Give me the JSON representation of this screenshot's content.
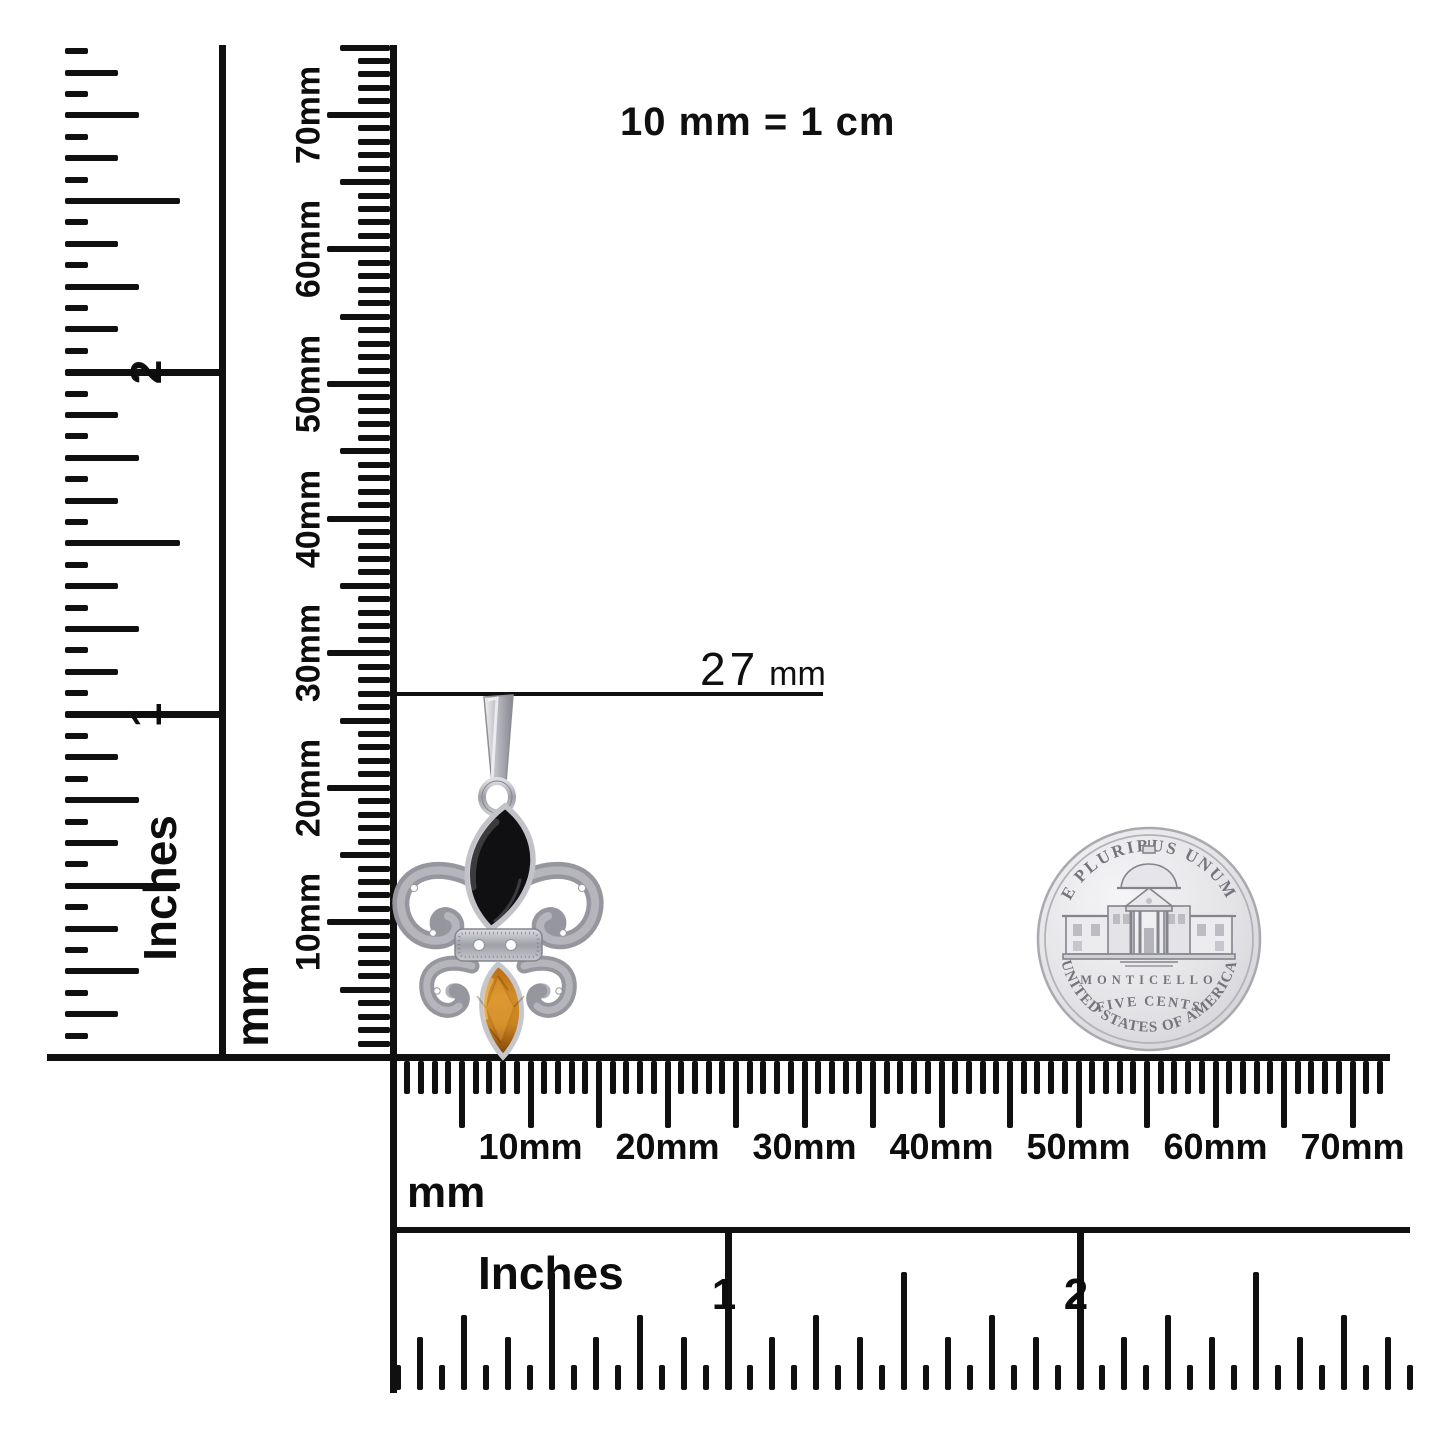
{
  "colors": {
    "ink": "#101010",
    "background": "#ffffff",
    "silver": "#c6c6cc",
    "silver_dark": "#8e8e96",
    "coin_face": "#dcdcdf",
    "coin_engraving": "#74747c",
    "onyx": "#101013",
    "citrine": "#c97a16",
    "citrine_dark": "#7c3f06"
  },
  "scale_note": "10 mm = 1 cm",
  "annotation": {
    "value": "27",
    "unit": "mm"
  },
  "left_inch_ruler": {
    "label": "Inches",
    "numerals": [
      "1",
      "2"
    ]
  },
  "left_mm_ruler": {
    "label": "mm",
    "tick_labels": [
      "10mm",
      "20mm",
      "30mm",
      "40mm",
      "50mm",
      "60mm",
      "70mm"
    ]
  },
  "bottom_mm_ruler": {
    "label": "mm",
    "tick_labels": [
      "10mm",
      "20mm",
      "30mm",
      "40mm",
      "50mm",
      "60mm",
      "70mm"
    ]
  },
  "bottom_inch_ruler": {
    "label": "Inches",
    "numerals": [
      "1",
      "2"
    ]
  },
  "pendant": {
    "description": "Fleur-de-lis pendant with black onyx marquise top stone, citrine marquise bottom stone and diamond-accented silver scrollwork",
    "measured_height": "27 mm"
  },
  "coin": {
    "legend_top": "E PLURIBUS UNUM",
    "building": "MONTICELLO",
    "denomination": "FIVE CENTS",
    "legend_bottom": "UNITED STATES OF AMERICA"
  }
}
